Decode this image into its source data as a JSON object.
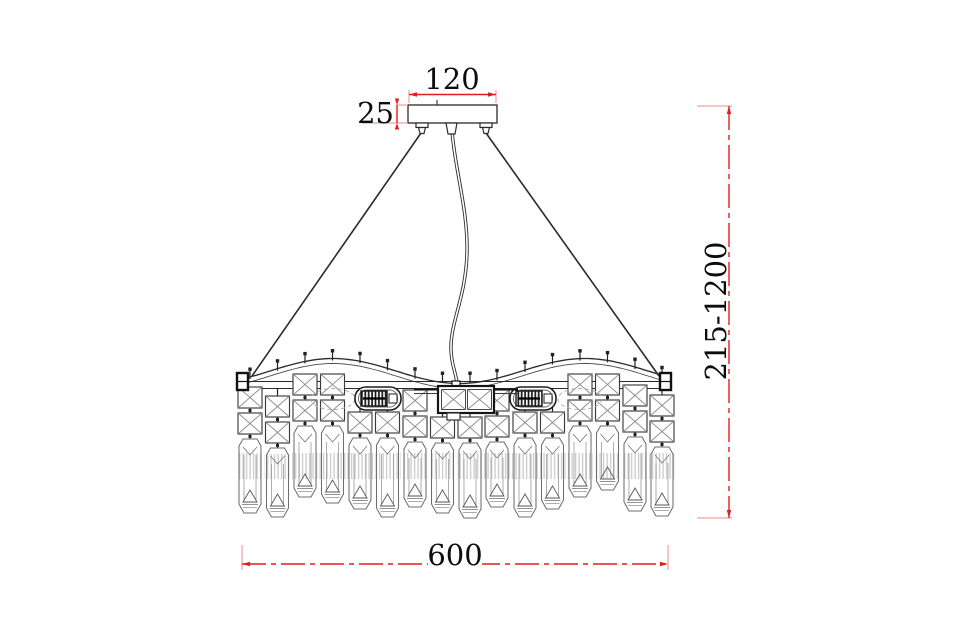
{
  "drawing": {
    "dimension_labels": {
      "canopy_width": "120",
      "canopy_height": "25",
      "height_range": "215-1200",
      "fixture_width": "600"
    },
    "colors": {
      "dimension_line": "#f28b8b",
      "dimension_accent": "#e31c1c",
      "ink": "#2a2a2a",
      "text": "#0d0d0d",
      "background": "#ffffff"
    }
  }
}
